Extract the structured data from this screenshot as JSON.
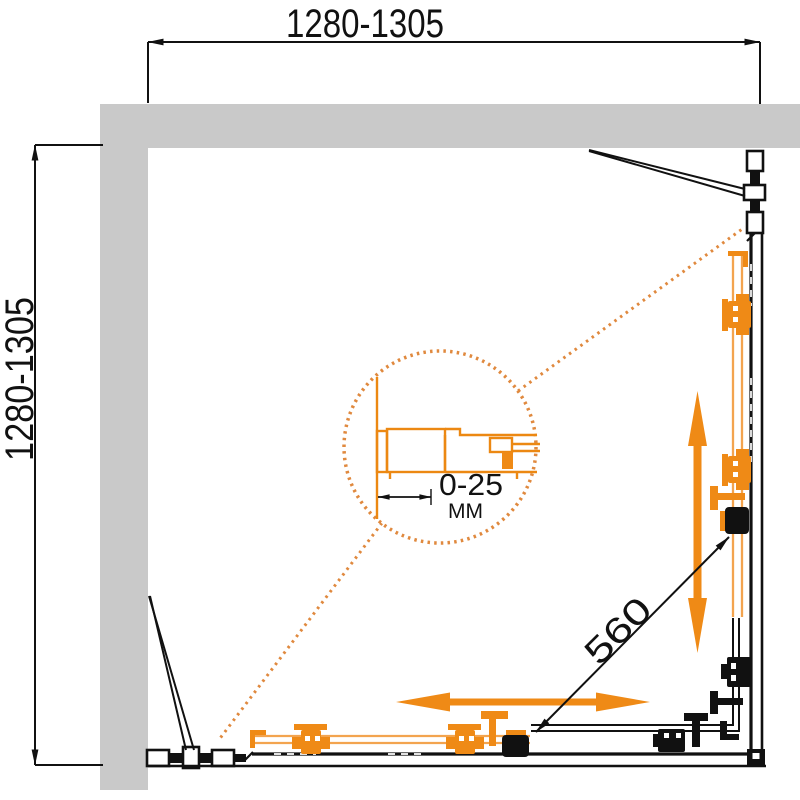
{
  "diagram": {
    "dimensions": {
      "width_range": "1280-1305",
      "depth_range": "1280-1305",
      "door_opening_diagonal": "560",
      "profile_adjustment_range": "0-25",
      "profile_adjustment_unit": "ММ"
    },
    "colors": {
      "wall_gray": "#C9C9C9",
      "line_black": "#111111",
      "hardware_orange": "#EF8A16",
      "door_orange": "#F3A44F",
      "callout_orange": "#E0893E"
    },
    "icons": {
      "vertical_arrow": "double-headed-slide-arrow",
      "horizontal_arrow": "double-headed-slide-arrow"
    }
  }
}
